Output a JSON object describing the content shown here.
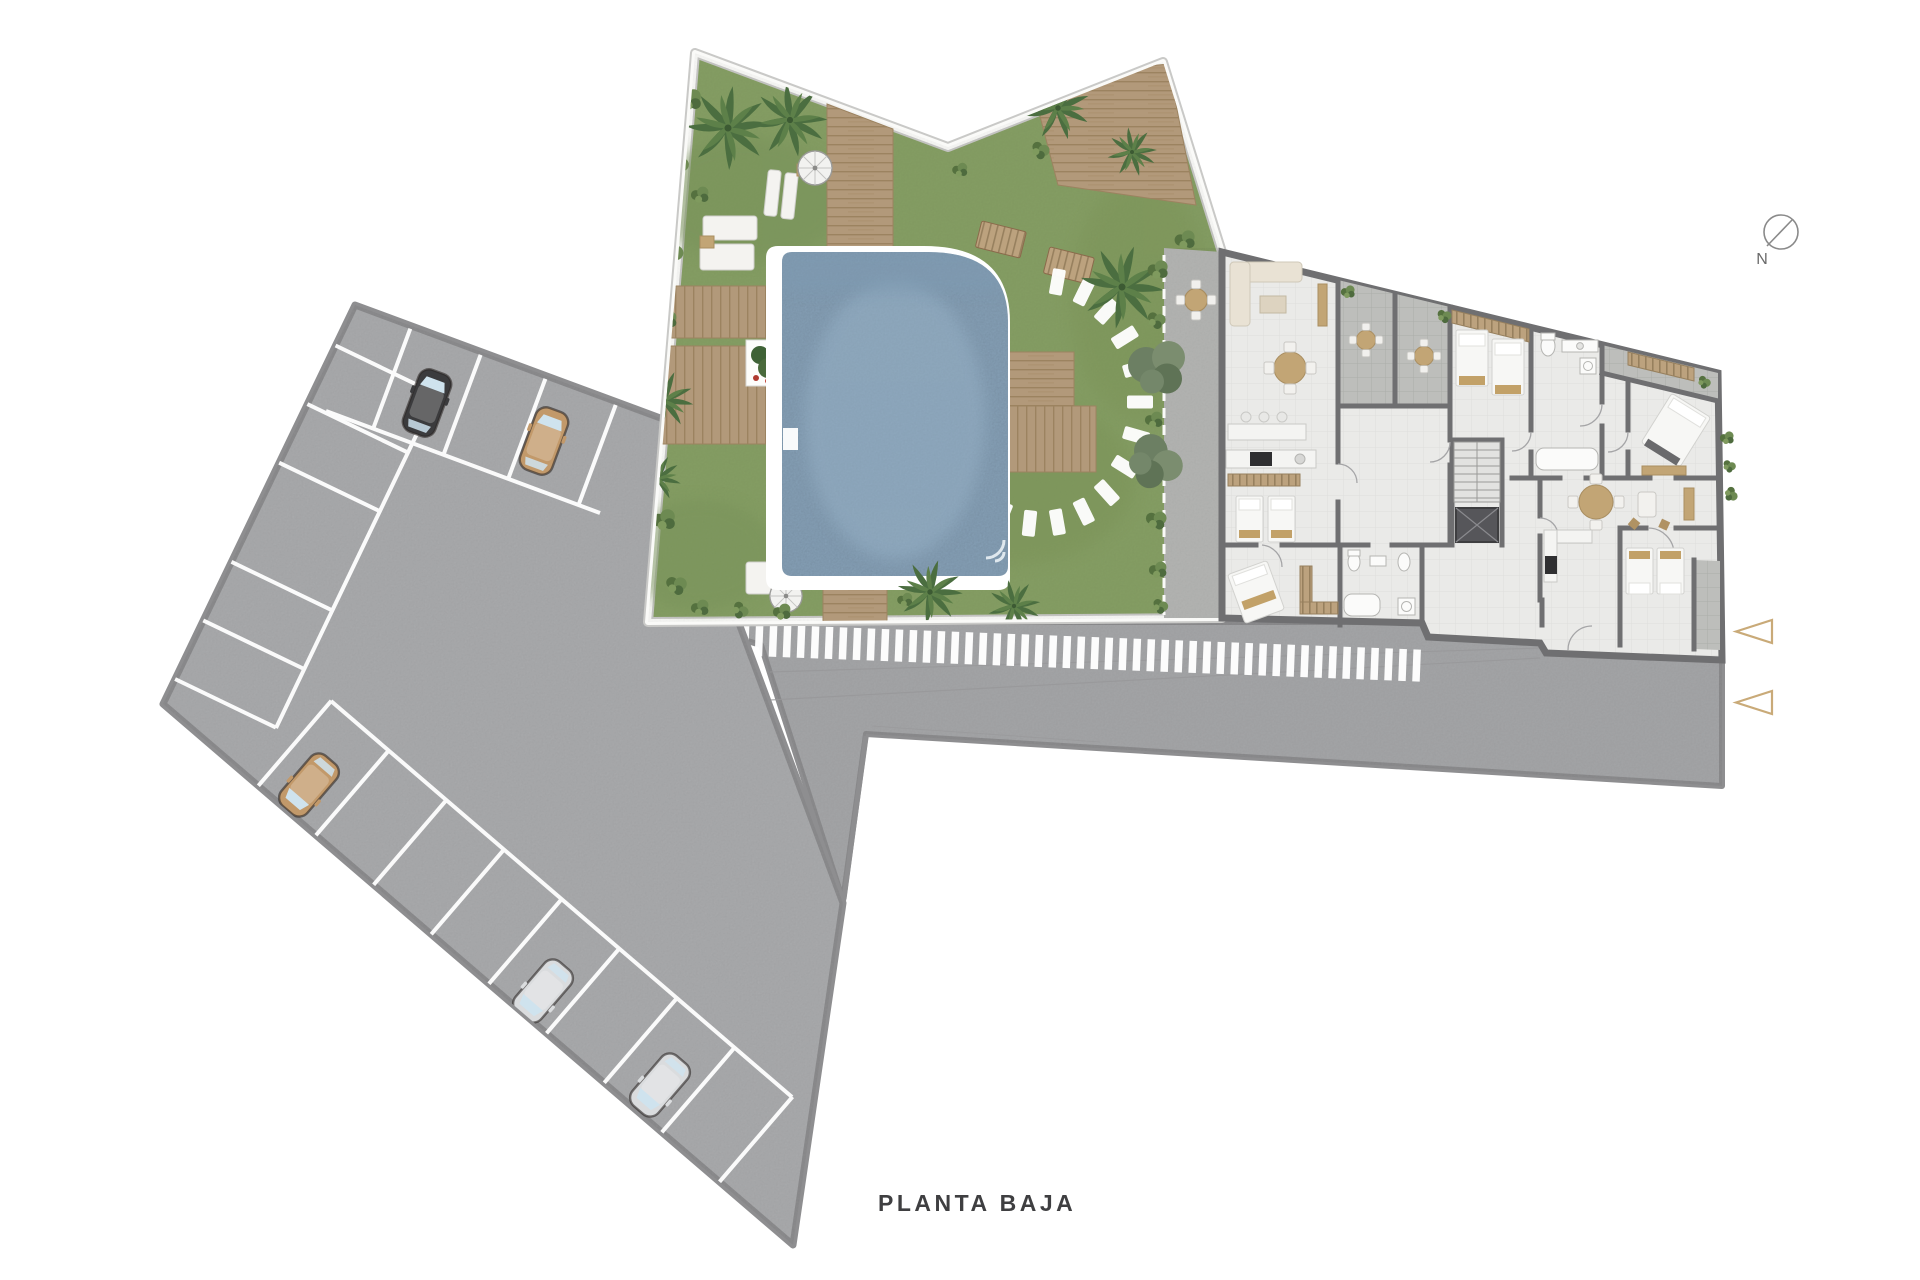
{
  "title": {
    "text": "PLANTA BAJA"
  },
  "compass": {
    "label": "N"
  },
  "entrance": {
    "arrow_count": 2,
    "arrow_color": "#c9aa78"
  },
  "parking": {
    "occupied_stalls": 5,
    "cars": [
      {
        "id": "car-black",
        "color_name": "black",
        "hex": "#3b3b3d"
      },
      {
        "id": "car-tan-top",
        "color_name": "tan",
        "hex": "#c2996a"
      },
      {
        "id": "car-tan-bottom",
        "color_name": "tan",
        "hex": "#c2996a"
      },
      {
        "id": "car-silver-1",
        "color_name": "silver",
        "hex": "#dadcde"
      },
      {
        "id": "car-silver-2",
        "color_name": "silver",
        "hex": "#dadcde"
      }
    ]
  },
  "site": {
    "features": [
      "parking lot",
      "access road",
      "crosswalk",
      "garden",
      "pool",
      "sun deck",
      "apartment building",
      "patio"
    ],
    "colors": {
      "asphalt": "#acadaf",
      "road": "#a7a8aa",
      "grass": "#87a065",
      "pool_water": "#8aa5bc",
      "wood_deck": "#b2997a",
      "wall": "#6f6f71",
      "terrace_tile": "#bdbebb",
      "floor": "#eaeae8"
    }
  }
}
